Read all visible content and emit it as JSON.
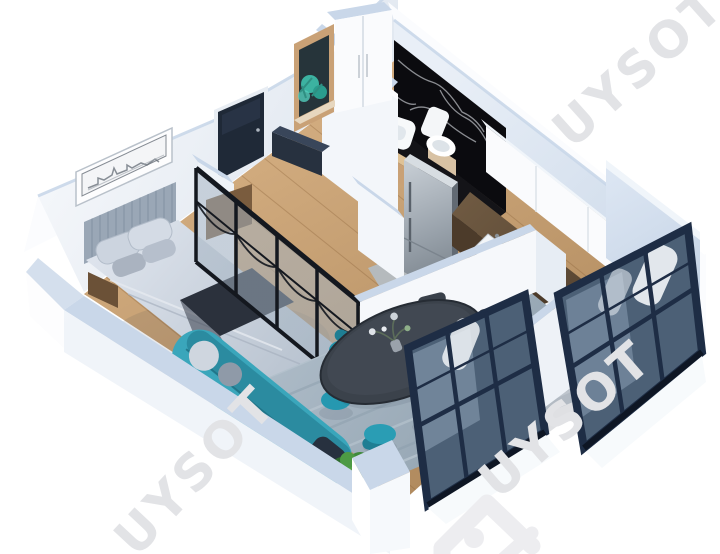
{
  "scene": {
    "kind": "isometric-3d-apartment-floor-plan-render",
    "background": "#ffffff",
    "rooms": [
      "bedroom",
      "entry-hall",
      "bathroom",
      "kitchen",
      "living-dining"
    ],
    "furniture": [
      "double-bed",
      "headboard",
      "skyline-wall-art",
      "nightstand",
      "entry-door",
      "mirror-console",
      "teal-plant",
      "wardrobe",
      "shoe-bench",
      "marble-wall",
      "wash-basin",
      "toilet",
      "fridge",
      "upper-cabinets",
      "kitchen-counter",
      "counter-sink",
      "stove-pots",
      "glass-partition",
      "area-rug",
      "teal-sofa",
      "dining-table",
      "teal-chairs",
      "dark-chairs",
      "floor-plant",
      "window-unit-left",
      "window-unit-right"
    ]
  },
  "watermark": {
    "text": "UYSOT",
    "color": "#e2e3e6",
    "count": 3
  },
  "logo": {
    "shape": "uysot-corner-mark",
    "color": "#ededf0"
  },
  "palette": {
    "bg": "#ffffff",
    "watermark": "#e2e3e6",
    "logoMark": "#ededf0",
    "wallFace": "#eef2f7",
    "wallTop": "#c9d7e9",
    "wallOuter": "#fbfcfe",
    "marble": "#0b0b0f",
    "marbleVein": "#cfd3d8",
    "woodFloor": "#c49c6f",
    "rug": "#a2b1bd",
    "rugRunner": "#b3bfca",
    "doorNavy": "#1f2937",
    "benchNavy": "#27313f",
    "headboard": "#9aa7b6",
    "bedding": "#cdd5e2",
    "throw": "#2b313c",
    "steel": "#99a2ab",
    "counterWood": "#5d4936",
    "cabinetWhite": "#fafbfd",
    "sinkWhite": "#f2f5f8",
    "teal": "#2e95a9",
    "tealDark": "#20798c",
    "chairTeal": "#2293ab",
    "chairDark": "#39404a",
    "tableTop": "#3b424b",
    "plantGreen": "#3f8a3b",
    "vanityWood": "#c9a176",
    "windowFrame": "#1e2d45",
    "windowGlass": "#4c6076",
    "glassPane": "#aab6c2",
    "partitionFrame": "#14181f"
  }
}
